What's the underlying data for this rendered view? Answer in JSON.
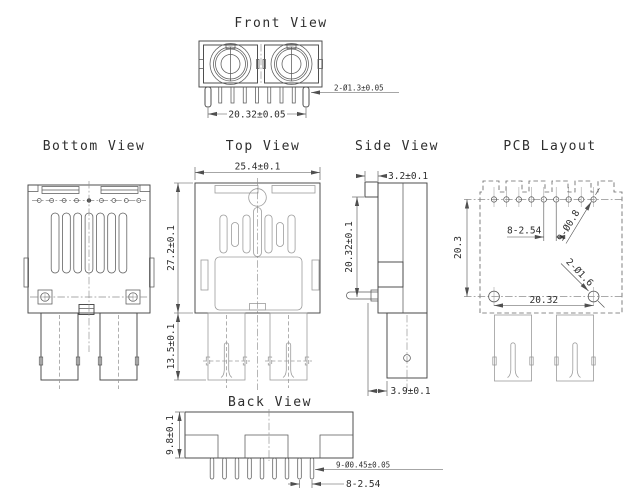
{
  "canvas": {
    "width": 632,
    "height": 492,
    "background": "#ffffff",
    "line_color": "#474747",
    "light_line_color": "#9c9c9c",
    "centerline_color": "#8f8f8f",
    "dim_color": "#4f4f4f",
    "text_color": "#2e2e2e"
  },
  "views": {
    "front": {
      "title": "Front View",
      "dims": {
        "pin_dia": "2-Ø1.3±0.05",
        "pitch": "20.32±0.05"
      }
    },
    "bottom": {
      "title": "Bottom View"
    },
    "top": {
      "title": "Top View",
      "dims": {
        "width": "25.4±0.1",
        "body_height": "27.2±0.1",
        "leg_height": "13.5±0.1"
      }
    },
    "side": {
      "title": "Side View",
      "dims": {
        "flange_depth": "3.2±0.1",
        "height": "20.32±0.1",
        "leg_offset": "3.9±0.1"
      }
    },
    "pcb": {
      "title": "PCB Layout",
      "dims": {
        "hole_pitch": "8-2.54",
        "small_holes": "9-Ø0.8",
        "large_holes": "2-Ø1.6",
        "span": "20.32",
        "height": "20.3"
      }
    },
    "back": {
      "title": "Back View",
      "dims": {
        "height": "9.8±0.1",
        "pin_dia": "9-Ø0.45±0.05",
        "pitch": "8-2.54"
      }
    }
  }
}
